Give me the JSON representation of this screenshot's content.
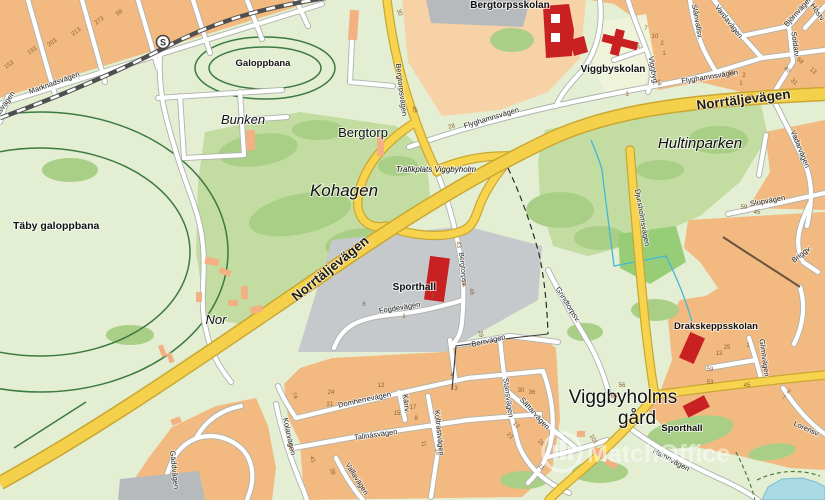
{
  "map": {
    "type": "static-street-map",
    "watermark": {
      "brand": "MatchOffice"
    },
    "station": {
      "label": "S"
    },
    "place_labels": [
      {
        "t": "Bergtorpsskolan",
        "x": 510,
        "y": 8,
        "s": 10,
        "w": 700
      },
      {
        "t": "Viggbyskolan",
        "x": 613,
        "y": 72,
        "s": 10,
        "w": 700
      },
      {
        "t": "Galoppbana",
        "x": 263,
        "y": 66,
        "s": 9.5,
        "w": 700
      },
      {
        "t": "Bunken",
        "x": 243,
        "y": 124,
        "s": 13,
        "i": 1
      },
      {
        "t": "Bergtorp",
        "x": 363,
        "y": 137,
        "s": 13
      },
      {
        "t": "Kohagen",
        "x": 344,
        "y": 196,
        "s": 17,
        "i": 1
      },
      {
        "t": "Täby galoppbana",
        "x": 13,
        "y": 229,
        "s": 10.5,
        "w": 700,
        "a": "start"
      },
      {
        "t": "Nor",
        "x": 216,
        "y": 324,
        "s": 13,
        "i": 1
      },
      {
        "t": "Hultinparken",
        "x": 700,
        "y": 148,
        "s": 15,
        "i": 1
      },
      {
        "t": "Trafikplats Viggbyholm",
        "x": 436,
        "y": 172,
        "s": 8,
        "i": 1,
        "c": "#3c3c3c"
      },
      {
        "t": "Sporthall",
        "x": 436,
        "y": 290,
        "s": 10,
        "w": 700,
        "a": "end"
      },
      {
        "t": "Drakskeppsskolan",
        "x": 716,
        "y": 329,
        "s": 9.5,
        "w": 700
      },
      {
        "t": "Viggbyholms",
        "x": 623,
        "y": 403,
        "s": 19
      },
      {
        "t": "gård",
        "x": 637,
        "y": 424,
        "s": 19
      },
      {
        "t": "Sporthall",
        "x": 682,
        "y": 431,
        "s": 9.5,
        "w": 700
      }
    ],
    "street_labels": [
      {
        "t": "Marknadsvägen",
        "x": 55,
        "y": 85,
        "r": -20
      },
      {
        "t": "dsvägen",
        "x": 7,
        "y": 105,
        "r": -55
      },
      {
        "t": "Bergtorpsvägen",
        "x": 399,
        "y": 90,
        "r": 83
      },
      {
        "t": "Flyghamnsvägen",
        "x": 492,
        "y": 120,
        "r": -17
      },
      {
        "t": "Flyghamnsvägen",
        "x": 710,
        "y": 79,
        "r": -9
      },
      {
        "t": "Norrtäljevägen",
        "x": 333,
        "y": 272,
        "r": -39,
        "s": 13.5,
        "w": 700
      },
      {
        "t": "Norrtäljevägen",
        "x": 744,
        "y": 104,
        "r": -7,
        "s": 13.5,
        "w": 700
      },
      {
        "t": "Bergtorpsv.",
        "x": 461,
        "y": 270,
        "r": 84,
        "s": 7
      },
      {
        "t": "Fogdevägen",
        "x": 400,
        "y": 310,
        "r": -9
      },
      {
        "t": "Djursholmsvägen",
        "x": 640,
        "y": 218,
        "r": 80
      },
      {
        "t": "Domherrevägen",
        "x": 365,
        "y": 402,
        "r": -12
      },
      {
        "t": "Tallnäsvägen",
        "x": 376,
        "y": 437,
        "r": -8
      },
      {
        "t": "Koltrastvägen",
        "x": 437,
        "y": 433,
        "r": 84
      },
      {
        "t": "Vallavägen",
        "x": 355,
        "y": 480,
        "r": 58
      },
      {
        "t": "Kolarvägen",
        "x": 287,
        "y": 437,
        "r": 78
      },
      {
        "t": "Stansvägen",
        "x": 506,
        "y": 398,
        "r": 82
      },
      {
        "t": "Sättarvägen",
        "x": 533,
        "y": 415,
        "r": 48
      },
      {
        "t": "Borrvägen",
        "x": 489,
        "y": 343,
        "r": -13
      },
      {
        "t": "Grindtorpsv.",
        "x": 566,
        "y": 306,
        "r": 58
      },
      {
        "t": "Slupvägen",
        "x": 768,
        "y": 203,
        "r": -10
      },
      {
        "t": "Briggv.",
        "x": 803,
        "y": 256,
        "r": -38
      },
      {
        "t": "Vadarvägen",
        "x": 798,
        "y": 150,
        "r": 68
      },
      {
        "t": "Soldatv.",
        "x": 793,
        "y": 45,
        "r": 83
      },
      {
        "t": "Björnvägen",
        "x": 800,
        "y": 13,
        "r": -48
      },
      {
        "t": "Vardavägen",
        "x": 727,
        "y": 23,
        "r": 52
      },
      {
        "t": "Slånvallsv.",
        "x": 695,
        "y": 22,
        "r": 80
      },
      {
        "t": "Viggbyg.",
        "x": 651,
        "y": 71,
        "r": 80
      },
      {
        "t": "Höstv.",
        "x": 816,
        "y": 14,
        "r": 55
      },
      {
        "t": "Hamnvägen",
        "x": 670,
        "y": 462,
        "r": 28
      },
      {
        "t": "Lorensv.",
        "x": 806,
        "y": 431,
        "r": 24
      },
      {
        "t": "Glimtvägen",
        "x": 762,
        "y": 358,
        "r": 82
      },
      {
        "t": "Gäddvägen",
        "x": 172,
        "y": 470,
        "r": 84
      },
      {
        "t": "Kärrv.",
        "x": 404,
        "y": 404,
        "r": 84
      }
    ],
    "house_numbers": [
      [
        "153",
        10,
        66,
        -35
      ],
      [
        "193",
        33,
        52,
        -35
      ],
      [
        "203",
        53,
        44,
        -35
      ],
      [
        "213",
        77,
        33,
        -35
      ],
      [
        "273",
        100,
        22,
        -35
      ],
      [
        "58",
        120,
        14,
        -35
      ],
      [
        "30",
        398,
        13,
        70
      ],
      [
        "49",
        413,
        110,
        70
      ],
      [
        "28",
        452,
        128,
        -15
      ],
      [
        "16",
        731,
        75,
        0
      ],
      [
        "7",
        646,
        30,
        0
      ],
      [
        "10",
        655,
        38,
        0
      ],
      [
        "2",
        662,
        45,
        0
      ],
      [
        "1",
        664,
        55,
        0
      ],
      [
        "5",
        638,
        48,
        0
      ],
      [
        "14",
        657,
        83,
        70
      ],
      [
        "3",
        627,
        96,
        0
      ],
      [
        "2",
        744,
        77,
        0
      ],
      [
        "1",
        741,
        85,
        0
      ],
      [
        "10",
        750,
        99,
        0
      ],
      [
        "31",
        793,
        83,
        40
      ],
      [
        "40",
        786,
        71,
        40
      ],
      [
        "58",
        799,
        62,
        40
      ],
      [
        "13",
        812,
        72,
        40
      ],
      [
        "59",
        744,
        209,
        0
      ],
      [
        "45",
        757,
        214,
        0
      ],
      [
        "25",
        727,
        349,
        0
      ],
      [
        "13",
        719,
        355,
        0
      ],
      [
        "1",
        748,
        347,
        0
      ],
      [
        "43",
        457,
        245,
        80
      ],
      [
        "46",
        470,
        292,
        80
      ],
      [
        "39",
        462,
        283,
        80
      ],
      [
        "6",
        364,
        306,
        0
      ],
      [
        "1",
        404,
        318,
        0
      ],
      [
        "2",
        433,
        298,
        0
      ],
      [
        "29",
        479,
        334,
        80
      ],
      [
        "24",
        331,
        394,
        0
      ],
      [
        "21",
        330,
        406,
        0
      ],
      [
        "12",
        381,
        387,
        0
      ],
      [
        "4",
        452,
        377,
        0
      ],
      [
        "3",
        456,
        390,
        0
      ],
      [
        "15",
        397,
        415,
        0
      ],
      [
        "17",
        413,
        409,
        0
      ],
      [
        "8",
        416,
        420,
        0
      ],
      [
        "11",
        422,
        444,
        80
      ],
      [
        "16",
        436,
        452,
        80
      ],
      [
        "74",
        293,
        396,
        70
      ],
      [
        "53",
        289,
        448,
        70
      ],
      [
        "41",
        311,
        460,
        70
      ],
      [
        "38",
        331,
        472,
        70
      ],
      [
        "30",
        521,
        392,
        0
      ],
      [
        "36",
        532,
        394,
        0
      ],
      [
        "13",
        515,
        426,
        45
      ],
      [
        "28",
        540,
        444,
        45
      ],
      [
        "21",
        509,
        437,
        45
      ],
      [
        "11",
        540,
        468,
        45
      ],
      [
        "56",
        622,
        387,
        0
      ],
      [
        "53",
        710,
        384,
        0
      ],
      [
        "45",
        747,
        387,
        0
      ],
      [
        "65",
        614,
        398,
        0
      ],
      [
        "101",
        592,
        440,
        60
      ],
      [
        "59",
        710,
        371,
        0
      ],
      [
        "2",
        788,
        393,
        30
      ],
      [
        "7",
        783,
        399,
        30
      ]
    ]
  }
}
